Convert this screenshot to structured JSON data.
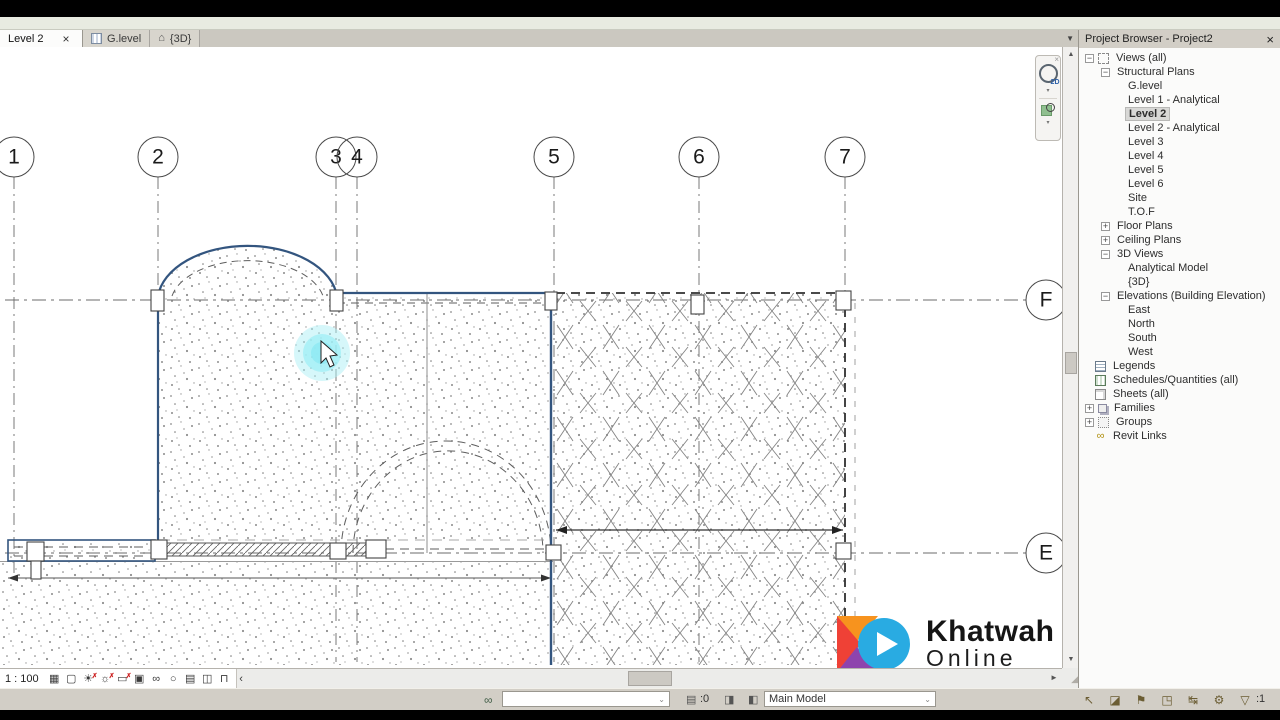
{
  "view_tabs": [
    {
      "label": "Level 2",
      "active": true,
      "close": "×"
    },
    {
      "label": "G.level",
      "icon": "plan-icon"
    },
    {
      "label": "{3D}",
      "icon": "house-icon",
      "icon_glyph": "⌂"
    }
  ],
  "tab_overflow_glyph": "▼",
  "project_browser": {
    "title": "Project Browser - Project2",
    "close_glyph": "×",
    "items": [
      {
        "label": "Views (all)",
        "indent": 6,
        "expand": "−",
        "icon": "views-icon"
      },
      {
        "label": "Structural Plans",
        "indent": 22,
        "expand": "−"
      },
      {
        "label": "G.level",
        "indent": 46
      },
      {
        "label": "Level 1 - Analytical",
        "indent": 46
      },
      {
        "label": "Level 2",
        "indent": 46,
        "selected": true
      },
      {
        "label": "Level 2 - Analytical",
        "indent": 46
      },
      {
        "label": "Level 3",
        "indent": 46
      },
      {
        "label": "Level 4",
        "indent": 46
      },
      {
        "label": "Level 5",
        "indent": 46
      },
      {
        "label": "Level 6",
        "indent": 46
      },
      {
        "label": "Site",
        "indent": 46
      },
      {
        "label": "T.O.F",
        "indent": 46
      },
      {
        "label": "Floor Plans",
        "indent": 22,
        "expand": "+"
      },
      {
        "label": "Ceiling Plans",
        "indent": 22,
        "expand": "+"
      },
      {
        "label": "3D Views",
        "indent": 22,
        "expand": "−"
      },
      {
        "label": "Analytical Model",
        "indent": 46
      },
      {
        "label": "{3D}",
        "indent": 46
      },
      {
        "label": "Elevations (Building Elevation)",
        "indent": 22,
        "expand": "−"
      },
      {
        "label": "East",
        "indent": 46
      },
      {
        "label": "North",
        "indent": 46
      },
      {
        "label": "South",
        "indent": 46
      },
      {
        "label": "West",
        "indent": 46
      },
      {
        "label": "Legends",
        "indent": 16,
        "icon": "legends-icon"
      },
      {
        "label": "Schedules/Quantities (all)",
        "indent": 16,
        "icon": "schedules-icon"
      },
      {
        "label": "Sheets (all)",
        "indent": 16,
        "icon": "sheets-icon"
      },
      {
        "label": "Families",
        "indent": 6,
        "expand": "+",
        "icon": "families-icon"
      },
      {
        "label": "Groups",
        "indent": 6,
        "expand": "+",
        "icon": "groups-icon"
      },
      {
        "label": "Revit Links",
        "indent": 16,
        "icon": "revit-links-icon",
        "icon_glyph": "∞"
      }
    ]
  },
  "view_control_bar": {
    "scale": "1 : 100",
    "buttons": [
      {
        "name": "detail-level",
        "glyph": "▦"
      },
      {
        "name": "visual-style",
        "glyph": "▢"
      },
      {
        "name": "sun-path",
        "glyph": "☀",
        "badge": "✗"
      },
      {
        "name": "shadows",
        "glyph": "☼",
        "badge": "✗"
      },
      {
        "name": "crop-view",
        "glyph": "▭",
        "badge": "✗"
      },
      {
        "name": "show-crop-region",
        "glyph": "▣"
      },
      {
        "name": "temporary-hide-isolate",
        "glyph": "∞"
      },
      {
        "name": "reveal-hidden-elements",
        "glyph": "○"
      },
      {
        "name": "temporary-view-properties",
        "glyph": "▤"
      },
      {
        "name": "show-analytical-model",
        "glyph": "◫"
      },
      {
        "name": "reveal-constraints",
        "glyph": "⊓"
      },
      {
        "name": "collapse",
        "glyph": "‹"
      }
    ]
  },
  "status_bar": {
    "workset_icon_glyph": "∞",
    "workset_value": "",
    "editing_requests_count": ":0",
    "editing_requests_glyph": "▤",
    "active_workset_glyph": "◨",
    "design_options_glyph": "◧",
    "design_option_value": "Main Model",
    "dropdown_caret": "⌄",
    "toggles": [
      {
        "name": "select-links-toggle",
        "glyph": "↖"
      },
      {
        "name": "select-underlay-elements-toggle",
        "glyph": "◪"
      },
      {
        "name": "select-pinned-elements-toggle",
        "glyph": "⚑"
      },
      {
        "name": "select-elements-by-face-toggle",
        "glyph": "◳"
      },
      {
        "name": "drag-elements-on-selection-toggle",
        "glyph": "↹"
      },
      {
        "name": "background-processes",
        "glyph": "⚙"
      },
      {
        "name": "filter",
        "glyph": "▽"
      }
    ],
    "filter_count": ":1"
  },
  "navigation_bar": {
    "wheel_label": "2D",
    "close_glyph": "×",
    "caret": "▾"
  },
  "scrollbar_glyphs": {
    "up": "▲",
    "down": "▼",
    "left": "◄",
    "right": "►",
    "grip": "◢"
  },
  "logo": {
    "title": "Khatwah",
    "subtitle": "Online",
    "mark_colors": {
      "orange": "#f7931e",
      "red": "#ef4136",
      "purple": "#8e44ad",
      "blue": "#29abe2"
    }
  },
  "drawing": {
    "view_name": "Level 2",
    "column_grids": [
      {
        "label": "1",
        "x": 14,
        "line_to": 585
      },
      {
        "label": "2",
        "x": 158,
        "line_to": 560
      },
      {
        "label": "3",
        "x": 336,
        "line_to": 662
      },
      {
        "label": "4",
        "x": 357,
        "line_to": 662
      },
      {
        "label": "5",
        "x": 554,
        "line_to": 662
      },
      {
        "label": "6",
        "x": 699,
        "line_to": 662
      },
      {
        "label": "7",
        "x": 845,
        "line_to": 300
      }
    ],
    "row_grids": [
      {
        "label": "F",
        "y": 300
      },
      {
        "label": "E",
        "y": 553
      }
    ],
    "bubble_radius": 20,
    "bubble_row_y": 157,
    "bubble_col_x": 1046,
    "cursor_highlight": {
      "x": 322,
      "y": 353,
      "color": "#8deef6"
    },
    "wall_color": "#33557f"
  }
}
